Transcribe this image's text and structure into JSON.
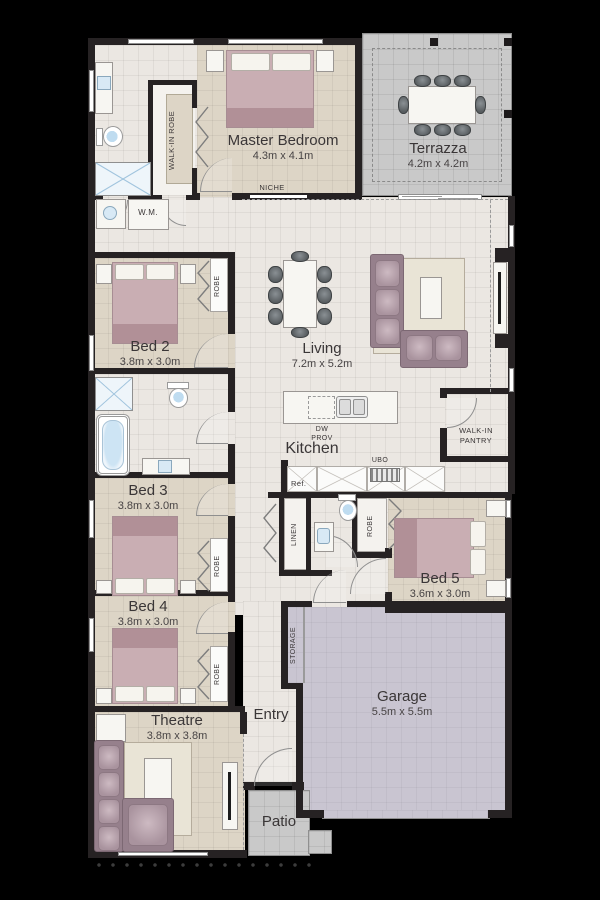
{
  "floorplan": {
    "rooms": {
      "master": {
        "name": "Master Bedroom",
        "dims": "4.3m x 4.1m"
      },
      "terrazza": {
        "name": "Terrazza",
        "dims": "4.2m x 4.2m"
      },
      "bed2": {
        "name": "Bed 2",
        "dims": "3.8m x 3.0m"
      },
      "living": {
        "name": "Living",
        "dims": "7.2m x 5.2m"
      },
      "kitchen": {
        "name": "Kitchen"
      },
      "bed3": {
        "name": "Bed 3",
        "dims": "3.8m x 3.0m"
      },
      "bed4": {
        "name": "Bed 4",
        "dims": "3.8m x 3.0m"
      },
      "bed5": {
        "name": "Bed 5",
        "dims": "3.6m x 3.0m"
      },
      "theatre": {
        "name": "Theatre",
        "dims": "3.8m x 3.8m"
      },
      "garage": {
        "name": "Garage",
        "dims": "5.5m x 5.5m"
      },
      "entry": {
        "name": "Entry"
      },
      "patio": {
        "name": "Patio"
      }
    },
    "labels": {
      "walk_in_robe": "WALK-IN ROBE",
      "niche": "NICHE",
      "wm": "W.M.",
      "robe": "ROBE",
      "linen": "LINEN",
      "storage": "STORAGE",
      "pantry1": "WALK-IN",
      "pantry2": "PANTRY",
      "dw1": "DW",
      "dw2": "PROV",
      "ubo": "UBO",
      "ref": "Ref."
    },
    "colors": {
      "background": "#000000",
      "wall": "#262223",
      "floor": "#ebe7e2",
      "bedroom_floor": "#ddd5c6",
      "outdoor": "#c9c9c9",
      "garage_floor": "#c9c5d1",
      "furniture_mauve": "#96808c",
      "water_accent": "#c3e0f2"
    }
  }
}
